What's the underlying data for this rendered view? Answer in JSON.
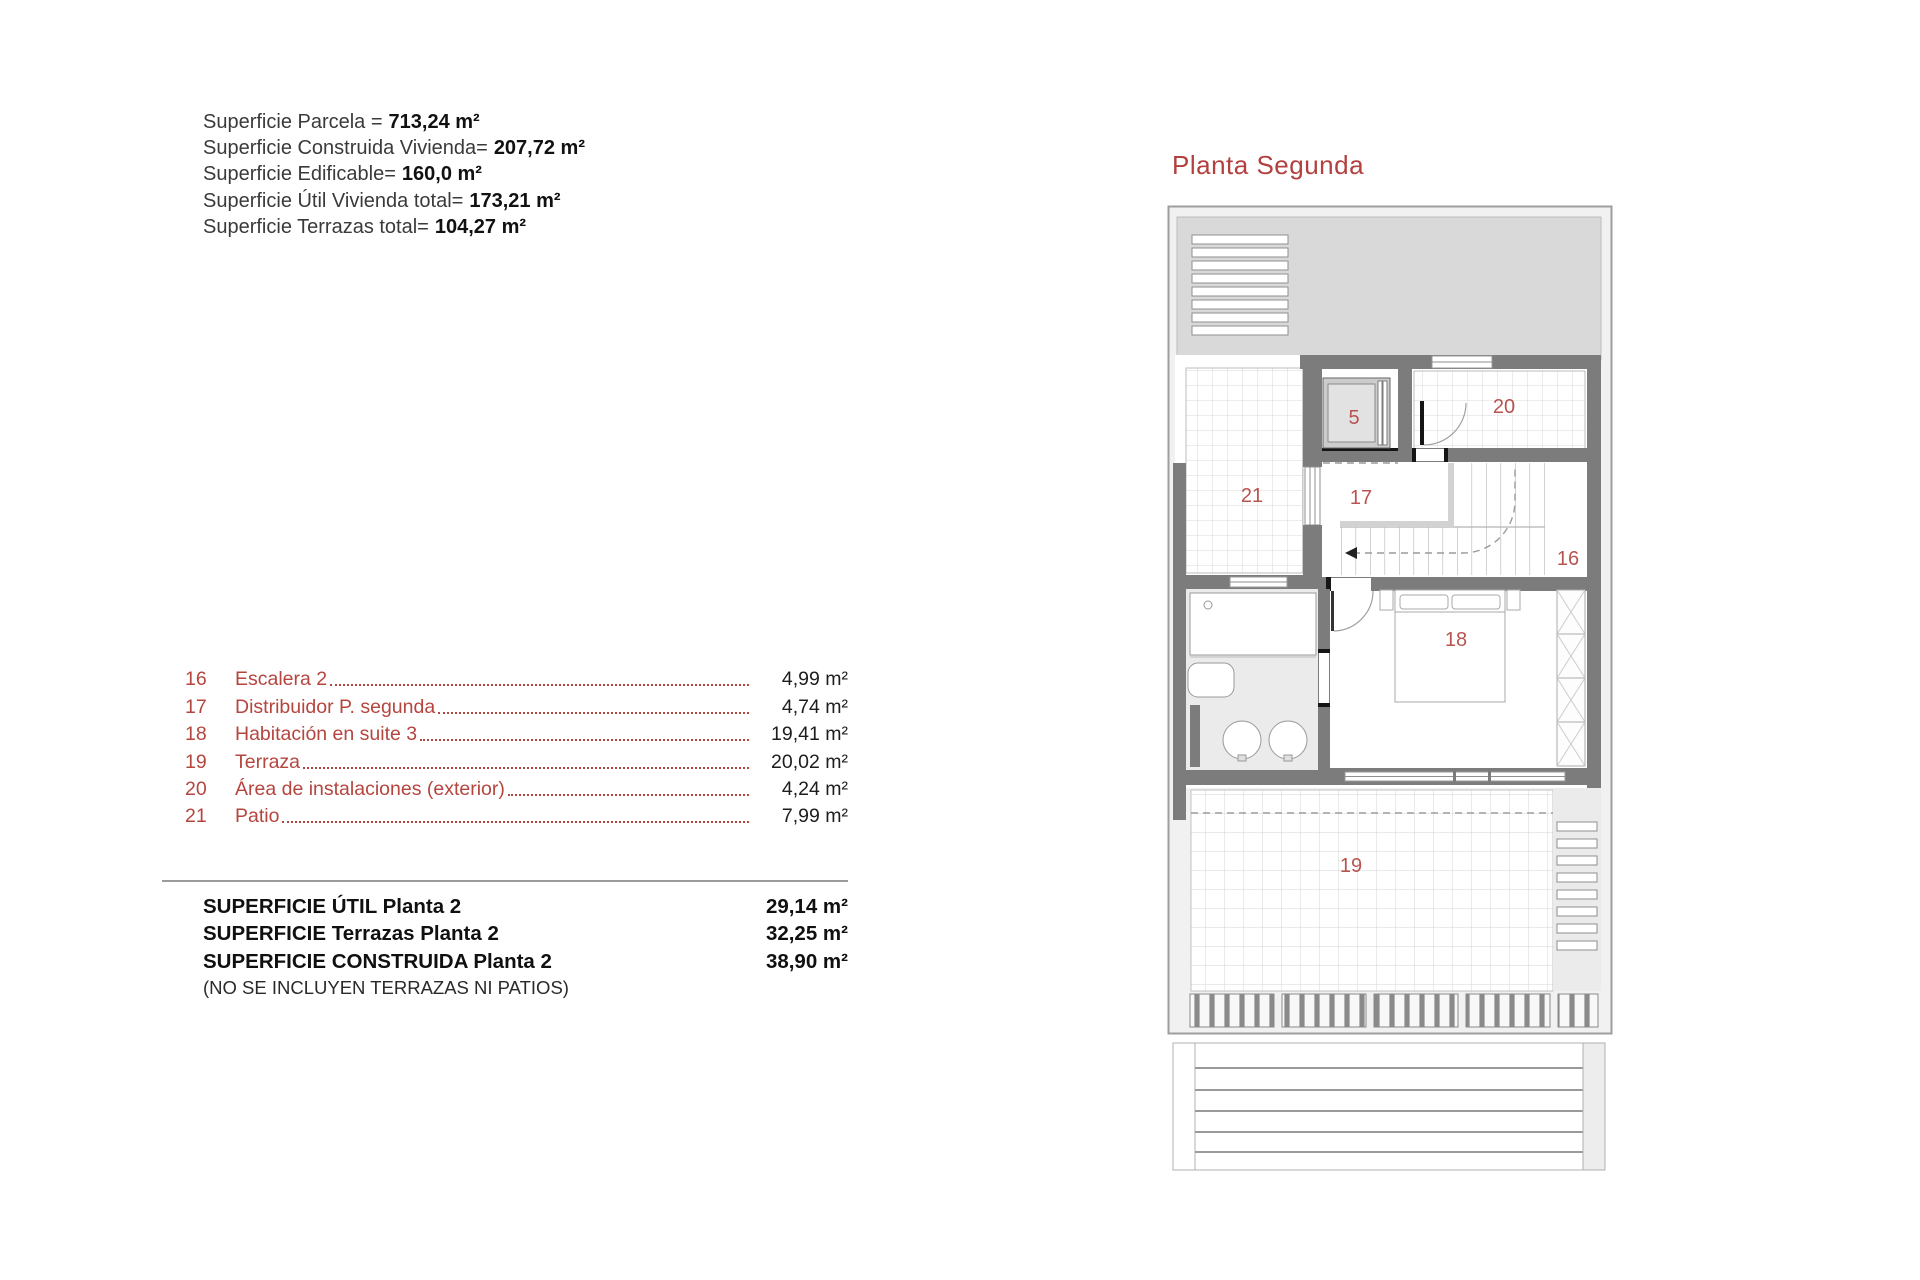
{
  "summary": {
    "lines": [
      {
        "label": "Superficie Parcela =",
        "value": "713,24 m²"
      },
      {
        "label": "Superficie Construida Vivienda=",
        "value": "207,72 m²"
      },
      {
        "label": "Superficie Edificable=",
        "value": "160,0 m²"
      },
      {
        "label": "Superficie Útil Vivienda total=",
        "value": "173,21 m²"
      },
      {
        "label": "Superficie Terrazas total=",
        "value": "104,27 m²"
      }
    ]
  },
  "room_list": {
    "rows": [
      {
        "number": "16",
        "name": "Escalera 2",
        "area": "4,99 m²"
      },
      {
        "number": "17",
        "name": "Distribuidor P. segunda",
        "area": "4,74 m²"
      },
      {
        "number": "18",
        "name": "Habitación en suite 3",
        "area": "19,41 m²"
      },
      {
        "number": "19",
        "name": "Terraza",
        "area": "20,02 m²"
      },
      {
        "number": "20",
        "name": "Área de instalaciones (exterior)",
        "area": "4,24 m²"
      },
      {
        "number": "21",
        "name": "Patio",
        "area": "7,99 m²"
      }
    ]
  },
  "totals": {
    "rows": [
      {
        "label": "SUPERFICIE ÚTIL Planta 2",
        "value": "29,14 m²"
      },
      {
        "label": "SUPERFICIE Terrazas Planta 2",
        "value": "32,25 m²"
      },
      {
        "label": "SUPERFICIE CONSTRUIDA Planta 2",
        "value": "38,90 m²"
      }
    ],
    "note": "(NO SE INCLUYEN TERRAZAS NI PATIOS)"
  },
  "plan": {
    "title": "Planta Segunda",
    "labels": {
      "lift": "5",
      "stairs": "16",
      "distributor": "17",
      "suite": "18",
      "terrace": "19",
      "installations": "20",
      "patio": "21"
    },
    "colors": {
      "accent_red": "#b2403f",
      "wall_gray": "#7c7c7c"
    }
  }
}
